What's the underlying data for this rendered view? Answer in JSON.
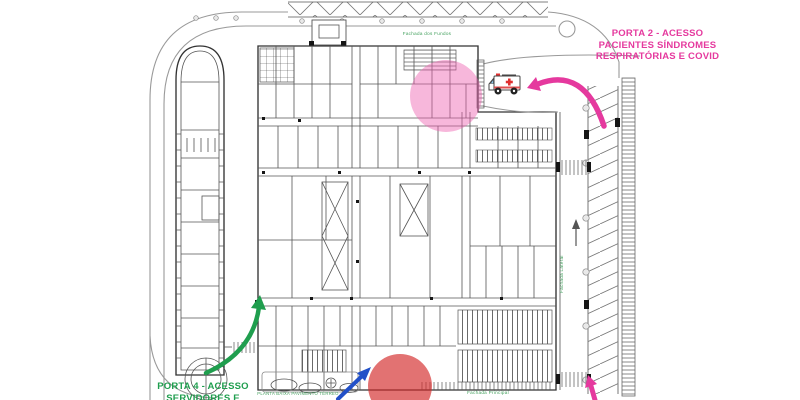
{
  "page": {
    "background": "#ffffff"
  },
  "plan": {
    "line_color": "#555555",
    "label_color": "#3f9e5a",
    "labels": {
      "rear_facade": "Fachada dos Fundos",
      "side_facade": "Fachada Lateral",
      "front_facade": "Fachada Principal",
      "caption": "PLANTA BAIXA PAVIMENTO TÉRREO"
    }
  },
  "callouts": {
    "porta2": {
      "label": "PORTA 2 - ACESSO\nPACIENTES SÍNDROMES\nRESPIRATÓRIAS E COVID",
      "color": "#e5399e"
    },
    "porta4": {
      "label": "PORTA 4 - ACESSO\nSERVIDORES E",
      "color": "#1f9e4e"
    },
    "covid_highlight_color": "#ee5fb0",
    "entrance_highlight_color": "#d22727",
    "porta2_arrow_color": "#e5399e",
    "parking_arrow_color": "#e5399e",
    "porta4_arrow_color": "#1f9e4e",
    "entrance_arrow_color": "#2150c8",
    "ambulance_icon": "🚑"
  }
}
